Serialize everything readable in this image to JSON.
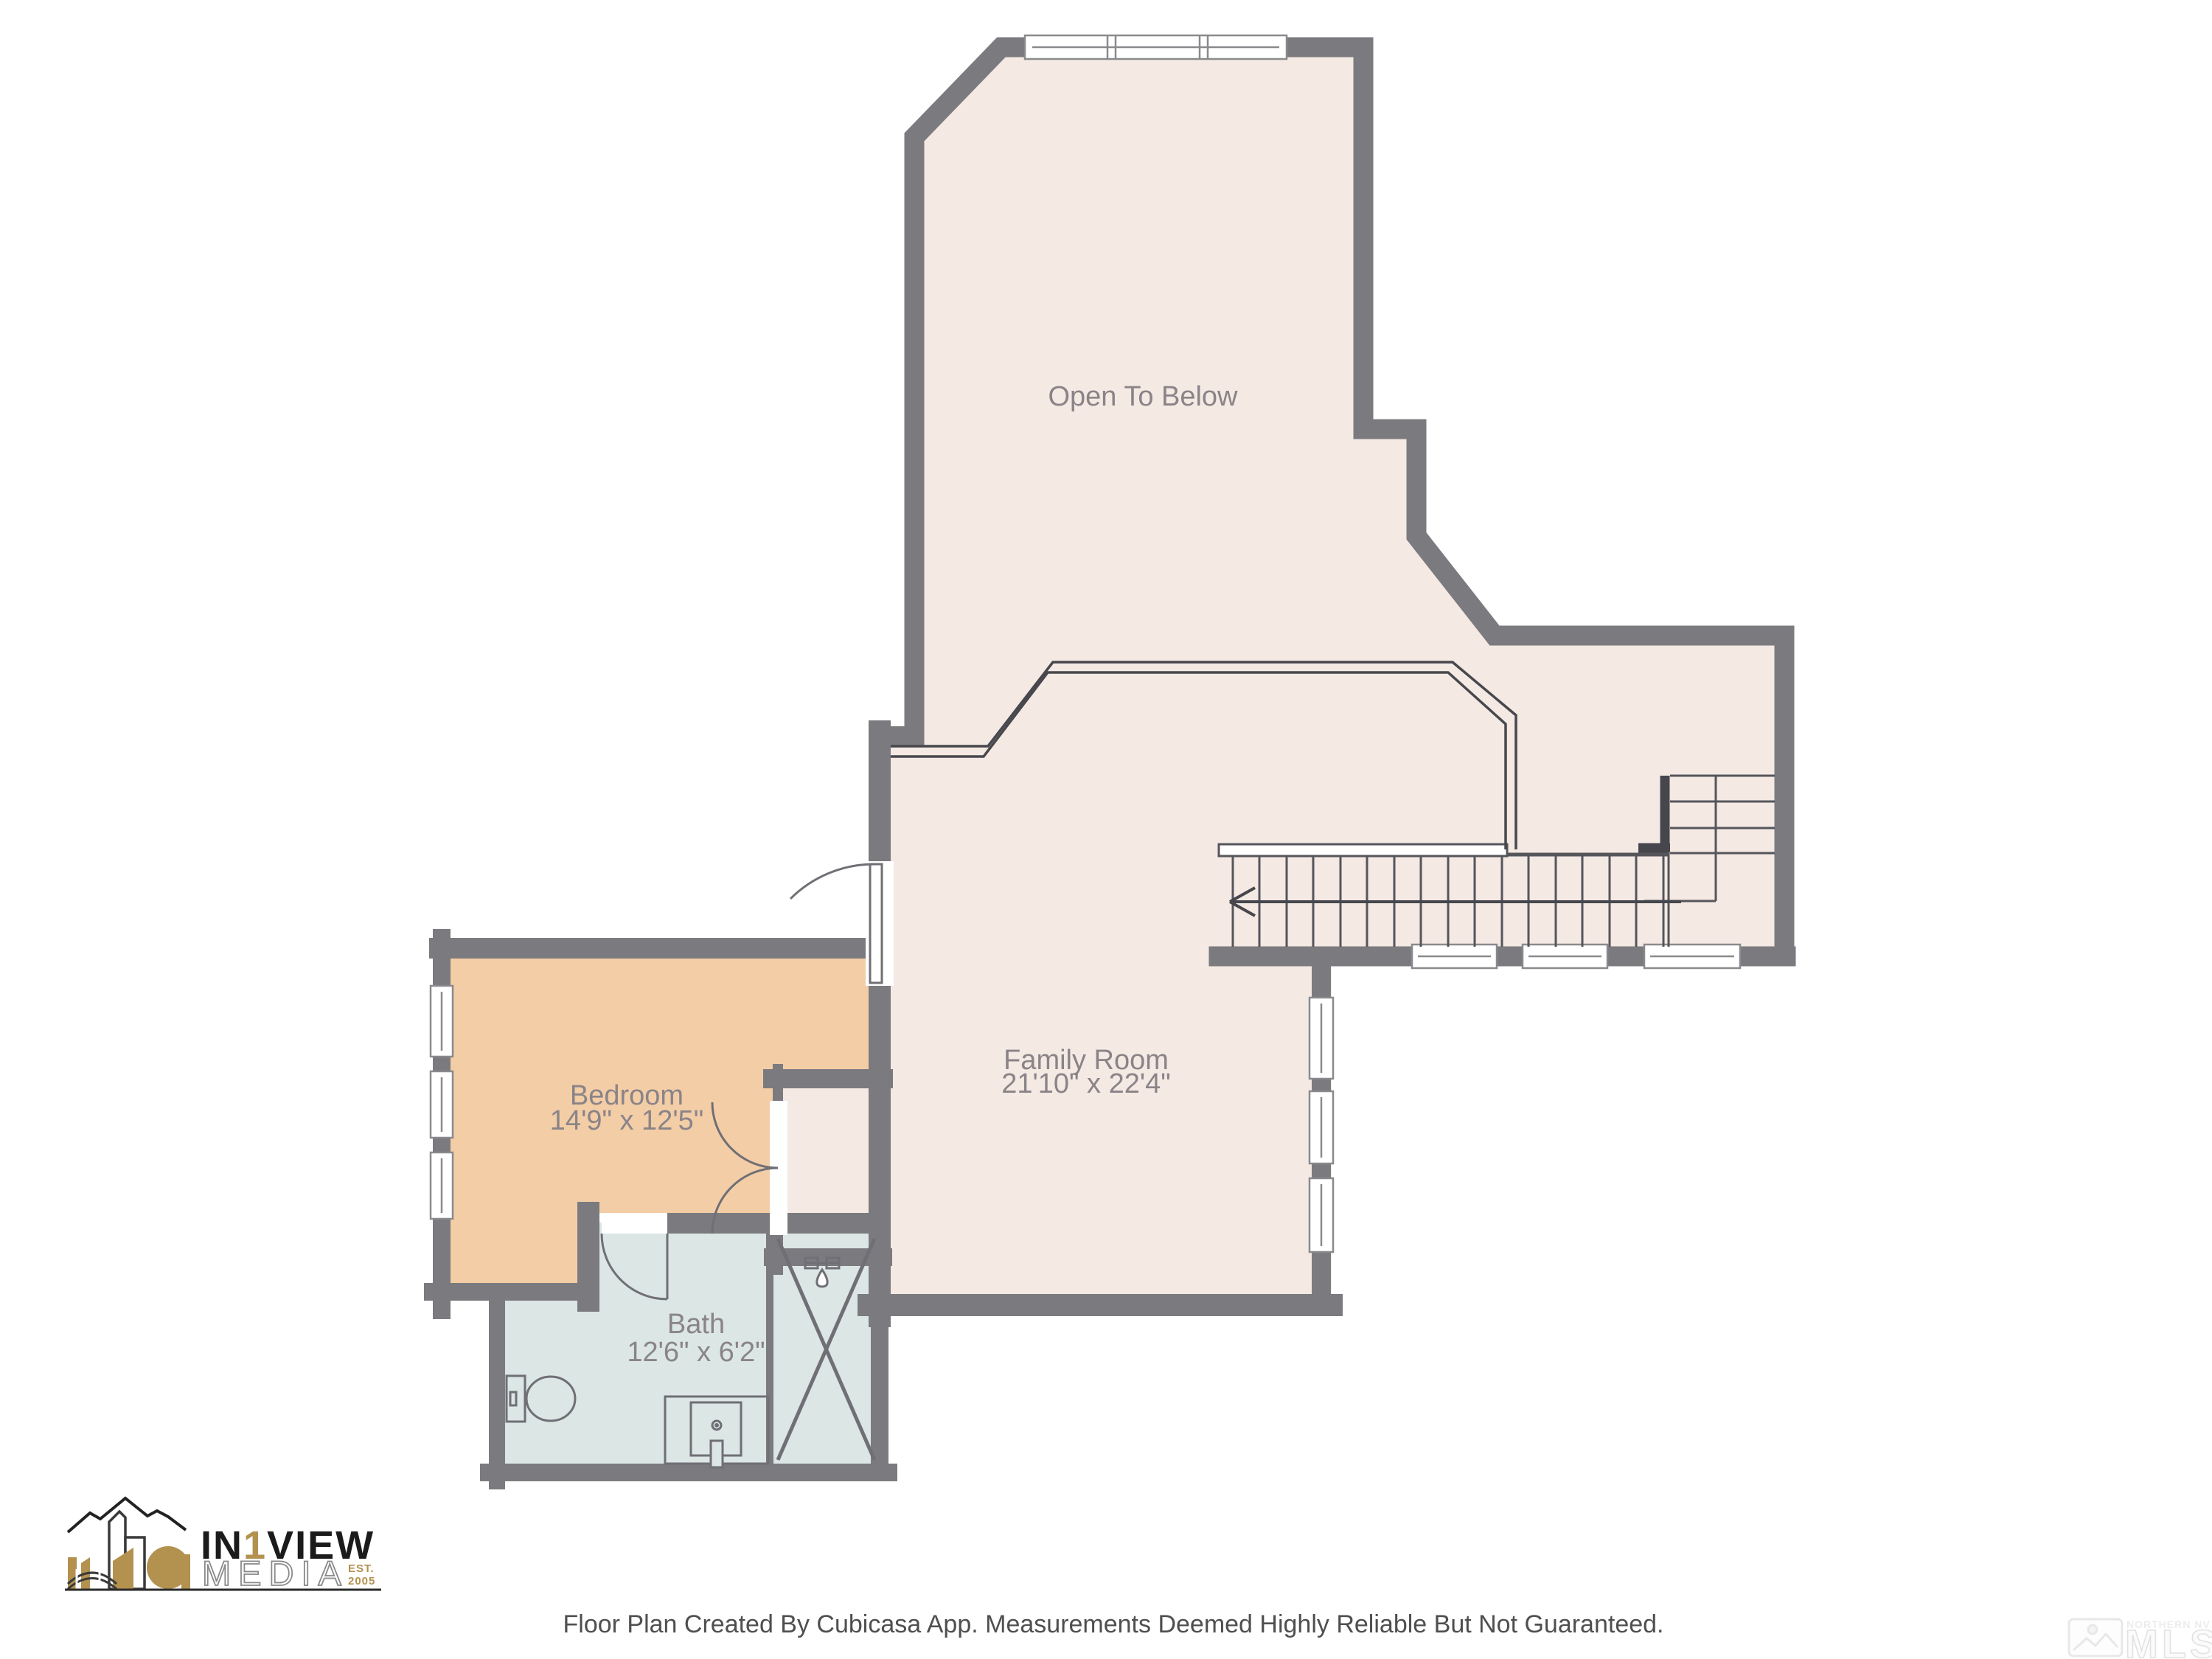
{
  "floor_plan": {
    "rooms": [
      {
        "id": "open_to_below",
        "label": "Open To Below",
        "dimensions": ""
      },
      {
        "id": "family_room",
        "label": "Family Room",
        "dimensions": "21'10\" x 22'4\""
      },
      {
        "id": "bedroom",
        "label": "Bedroom",
        "dimensions": "14'9\" x 12'5\""
      },
      {
        "id": "bath",
        "label": "Bath",
        "dimensions": "12'6\" x 6'2\""
      }
    ],
    "colors": {
      "wall": "#7b7b7f",
      "floor": "#f4e9e3",
      "bedroom_floor": "#f3cda6",
      "bath_floor": "#dbe6e5",
      "label_text": "#8a8488",
      "fixture_line": "#6f6f75",
      "railing_line": "#47474d"
    }
  },
  "logo": {
    "part1": "IN",
    "part2": "1",
    "part3": "VIEW",
    "media": "MEDIA",
    "est": "EST.",
    "year": "2005"
  },
  "watermark": {
    "line1": "NORTHERN NV REGIONAL",
    "line2": "MLS"
  },
  "disclaimer": "Floor Plan Created By Cubicasa App. Measurements Deemed Highly Reliable But Not Guaranteed."
}
